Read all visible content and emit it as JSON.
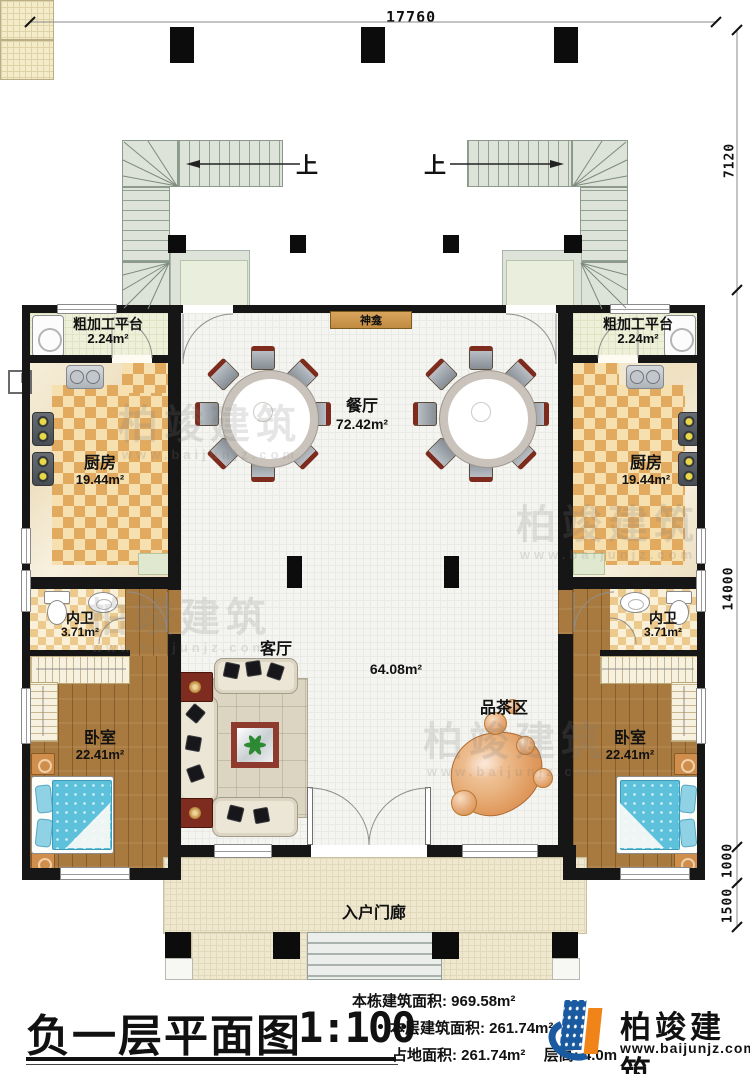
{
  "dimensions": {
    "top": "17760",
    "right_upper": "7120",
    "right_main": "14000",
    "right_step1": "1000",
    "right_step2": "1500"
  },
  "stairs": {
    "up_left": "上",
    "up_right": "上"
  },
  "rooms": {
    "shrine": {
      "name": "神龛"
    },
    "platform_left": {
      "name": "粗加工平台",
      "area": "2.24m²"
    },
    "platform_right": {
      "name": "粗加工平台",
      "area": "2.24m²"
    },
    "kitchen_left": {
      "name": "厨房",
      "area": "19.44m²"
    },
    "kitchen_right": {
      "name": "厨房",
      "area": "19.44m²"
    },
    "dining": {
      "name": "餐厅",
      "area": "72.42m²"
    },
    "hall": {
      "area": "64.08m²"
    },
    "living": {
      "name": "客厅"
    },
    "tea": {
      "name": "品茶区"
    },
    "bath_left": {
      "name": "内卫",
      "area": "3.71m²"
    },
    "bath_right": {
      "name": "内卫",
      "area": "3.71m²"
    },
    "bedroom_left": {
      "name": "卧室",
      "area": "22.41m²"
    },
    "bedroom_right": {
      "name": "卧室",
      "area": "22.41m²"
    },
    "porch": {
      "name": "入户门廊"
    }
  },
  "titleblock": {
    "title": "负一层平面图",
    "scale": "1:100",
    "stat1_label": "本栋建筑面积:",
    "stat1_value": "969.58m²",
    "stat2_label": "本层建筑面积:",
    "stat2_value": "261.74m²",
    "stat3_label": "占地面积:",
    "stat3_value": "261.74m²",
    "stat4_label": "层高:",
    "stat4_value": "4.0m"
  },
  "brand": {
    "name": "柏竣建筑",
    "url": "www.baijunjz.com"
  },
  "watermark": {
    "text": "柏竣建筑",
    "url": "www.baijunjz.com"
  }
}
